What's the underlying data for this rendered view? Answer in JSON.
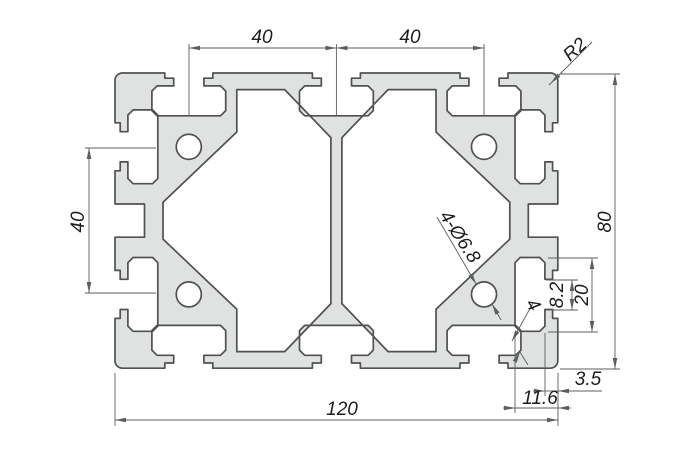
{
  "drawing": {
    "dimensions": {
      "top_pitch_left": "40",
      "top_pitch_right": "40",
      "side_pitch": "40",
      "overall_width": "120",
      "overall_height": "80",
      "corner_radius": "R2",
      "hole_callout": "4-Ø6.8",
      "wall_thickness": "4",
      "slot_opening": "8.2",
      "slot_inner_width": "20",
      "slot_lip_depth": "3.5",
      "slot_depth": "11.6"
    },
    "colors": {
      "background": "#ffffff",
      "profile_fill": "#e0e2e1",
      "profile_outline": "#4f5251",
      "dim_line": "#5b5f5d",
      "dim_text": "#1c1e1d"
    }
  }
}
